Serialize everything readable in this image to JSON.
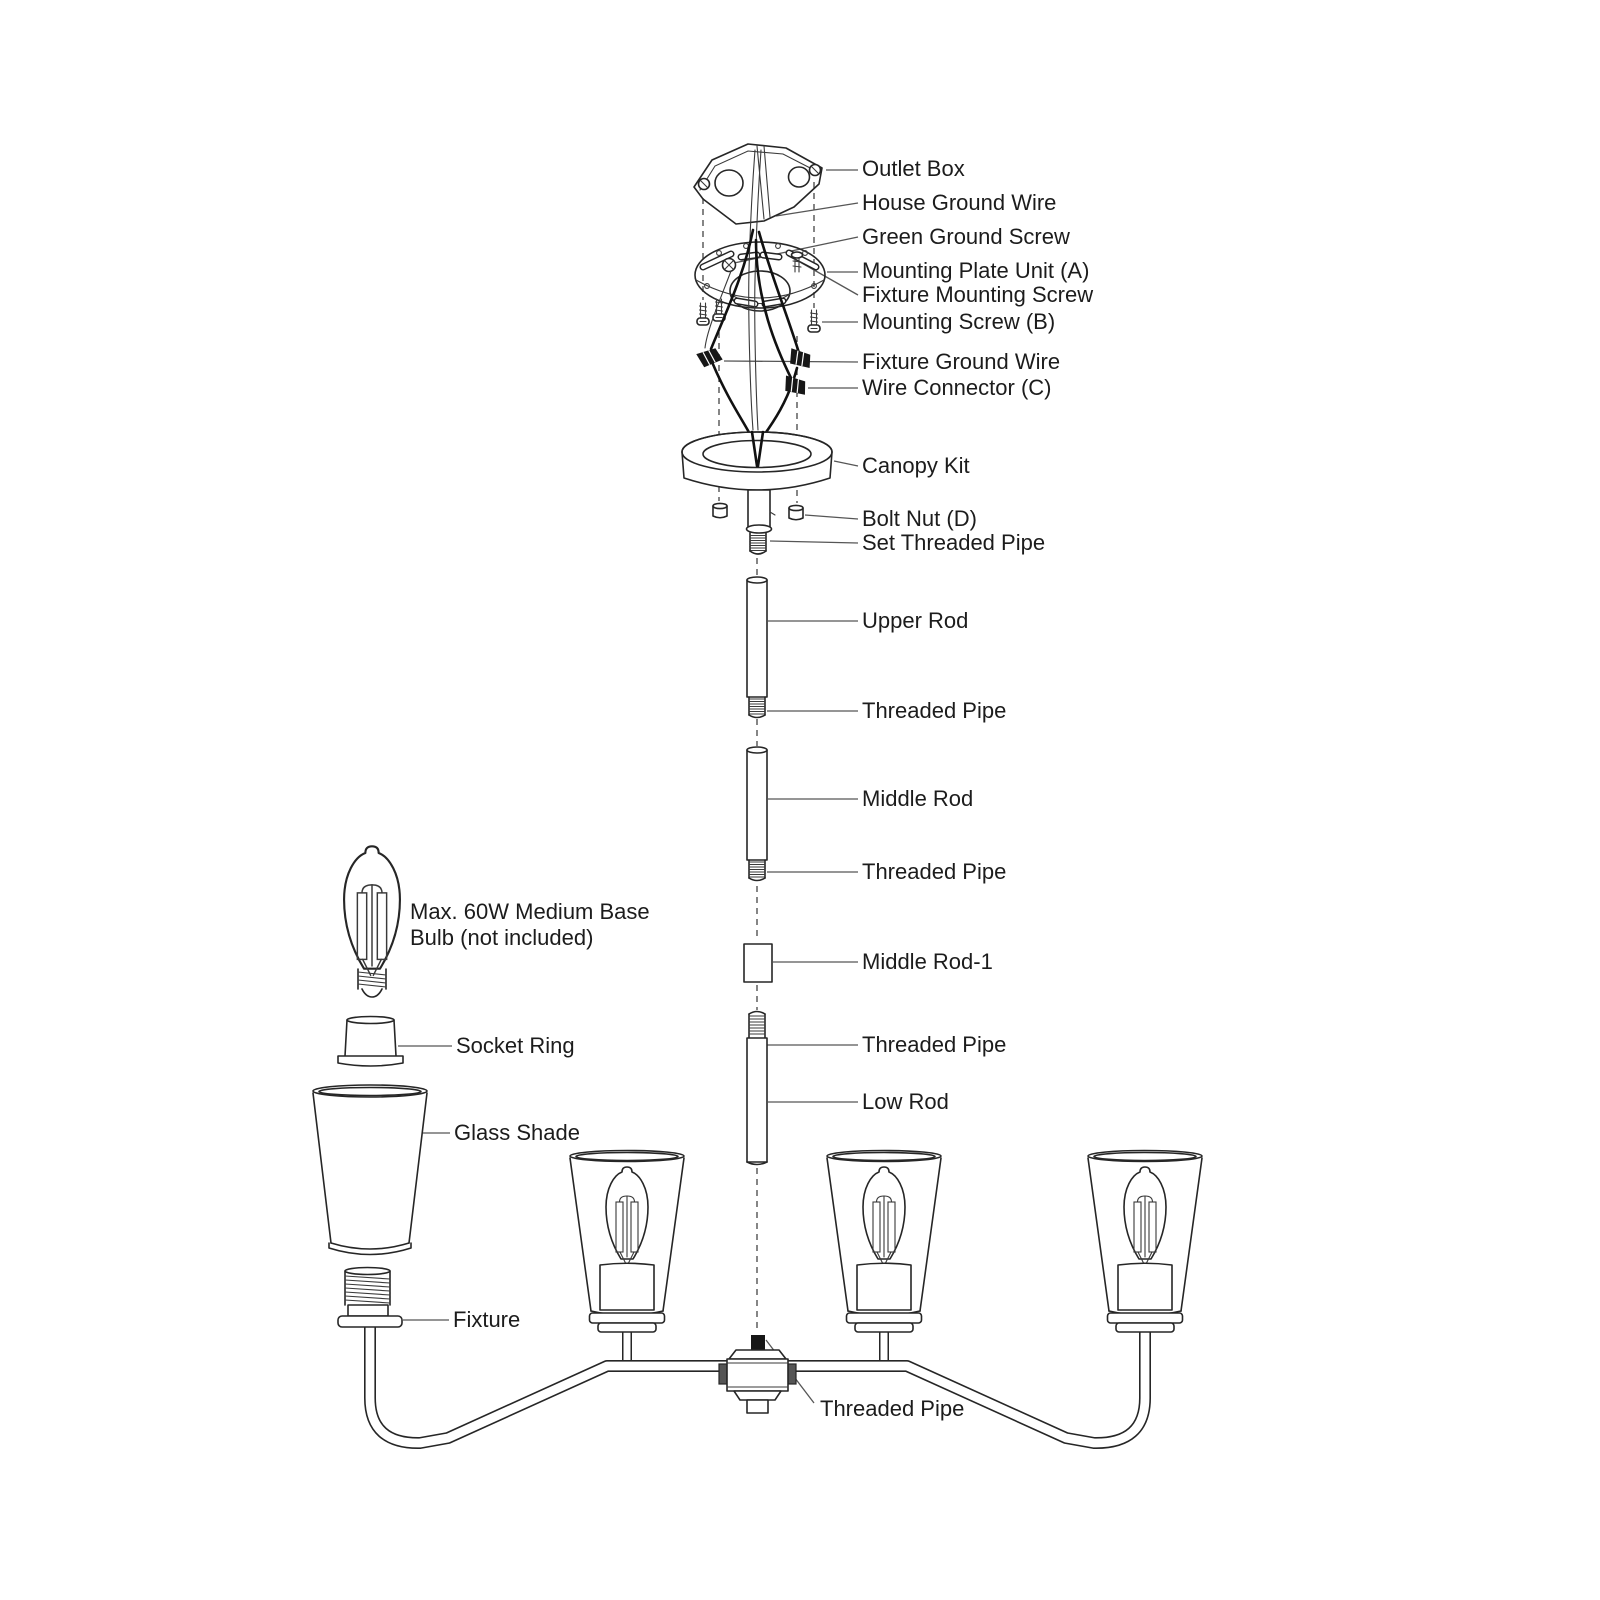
{
  "diagram": {
    "type": "exploded-assembly-diagram",
    "subject": "chandelier ceiling light fixture installation parts diagram",
    "colors": {
      "background": "#ffffff",
      "line": "#262626",
      "text": "#1c1c1c",
      "leader": "#565656"
    },
    "labels": {
      "outlet_box": "Outlet Box",
      "house_ground_wire": "House Ground Wire",
      "green_ground_screw": "Green Ground Screw",
      "mounting_plate_unit": "Mounting Plate Unit (A)",
      "fixture_mounting_screw": "Fixture Mounting Screw",
      "mounting_screw_b": "Mounting Screw (B)",
      "fixture_ground_wire": "Fixture Ground Wire",
      "wire_connector_c": "Wire Connector (C)",
      "canopy_kit": "Canopy Kit",
      "bolt_nut_d": "Bolt Nut (D)",
      "set_threaded_pipe": "Set Threaded Pipe",
      "upper_rod": "Upper Rod",
      "threaded_pipe_1": "Threaded Pipe",
      "middle_rod": "Middle Rod",
      "threaded_pipe_2": "Threaded Pipe",
      "middle_rod_1": "Middle Rod-1",
      "threaded_pipe_3": "Threaded Pipe",
      "low_rod": "Low Rod",
      "bulb_note_line1": "Max. 60W Medium Base",
      "bulb_note_line2": "Bulb (not included)",
      "socket_ring": "Socket Ring",
      "glass_shade": "Glass Shade",
      "fixture": "Fixture",
      "threaded_pipe_4": "Threaded Pipe"
    }
  }
}
